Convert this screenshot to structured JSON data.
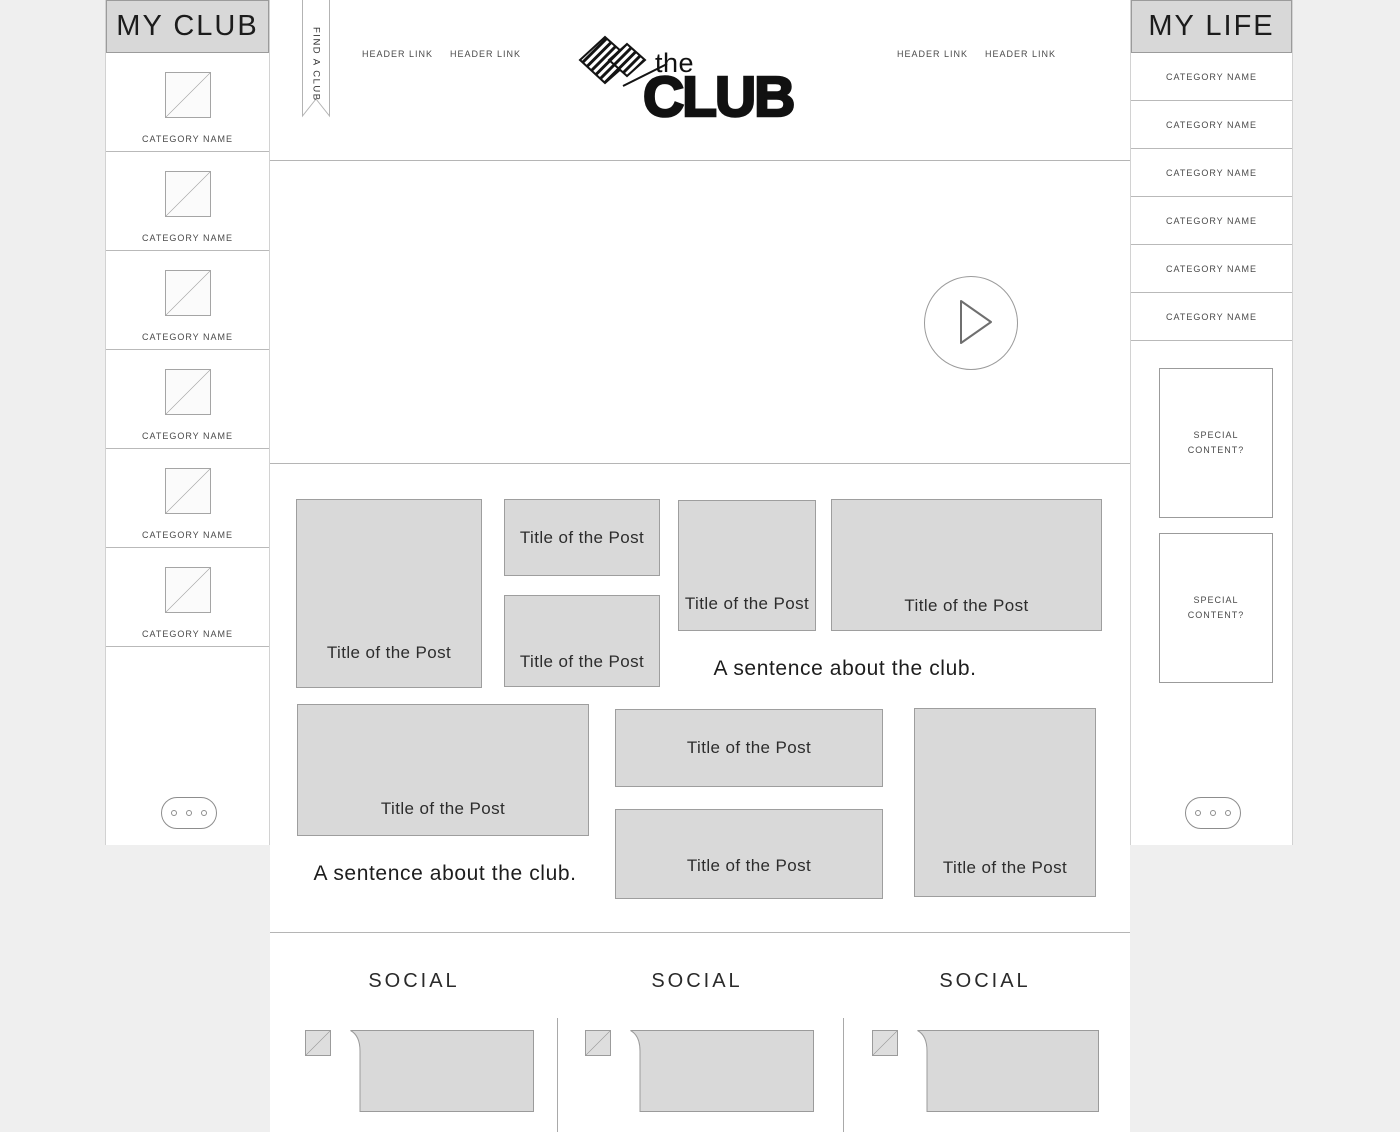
{
  "colors": {
    "page_bg": "#efefef",
    "panel_bg": "#ffffff",
    "box_fill": "#d9d9d9",
    "box_border": "#9b9b9b",
    "text_dark": "#1c1c1c",
    "text_mid": "#4a4a4a"
  },
  "left_sidebar": {
    "title": "MY CLUB",
    "items": [
      {
        "label": "CATEGORY NAME",
        "image": "image-placeholder"
      },
      {
        "label": "CATEGORY NAME",
        "image": "image-placeholder"
      },
      {
        "label": "CATEGORY NAME",
        "image": "image-placeholder"
      },
      {
        "label": "CATEGORY NAME",
        "image": "image-placeholder"
      },
      {
        "label": "CATEGORY NAME",
        "image": "image-placeholder"
      },
      {
        "label": "CATEGORY NAME",
        "image": "image-placeholder"
      }
    ],
    "more_icon": "ellipsis-icon"
  },
  "right_sidebar": {
    "title": "MY LIFE",
    "items": [
      {
        "label": "CATEGORY NAME"
      },
      {
        "label": "CATEGORY NAME"
      },
      {
        "label": "CATEGORY NAME"
      },
      {
        "label": "CATEGORY NAME"
      },
      {
        "label": "CATEGORY NAME"
      },
      {
        "label": "CATEGORY NAME"
      }
    ],
    "special_boxes": [
      {
        "label": "SPECIAL\nCONTENT?"
      },
      {
        "label": "SPECIAL\nCONTENT?"
      }
    ],
    "more_icon": "ellipsis-icon"
  },
  "ribbon": {
    "label": "FIND A CLUB"
  },
  "header": {
    "links": [
      {
        "label": "HEADER LINK"
      },
      {
        "label": "HEADER LINK"
      },
      {
        "label": "HEADER LINK"
      },
      {
        "label": "HEADER LINK"
      }
    ],
    "logo": {
      "the": "the",
      "club": "CLUB",
      "icon": "interlocked-hands-icon"
    }
  },
  "video": {
    "play_icon": "play-icon"
  },
  "posts": {
    "items": [
      {
        "title": "Title of the Post"
      },
      {
        "title": "Title of the Post"
      },
      {
        "title": "Title of the Post"
      },
      {
        "title": "Title of the Post"
      },
      {
        "title": "Title of the Post"
      },
      {
        "title": "Title of the Post"
      },
      {
        "title": "Title of the Post"
      },
      {
        "title": "Title of the Post"
      },
      {
        "title": "Title of the Post"
      }
    ],
    "sentence_right": "A sentence about the club.",
    "sentence_left": "A sentence about the club."
  },
  "social": {
    "columns": [
      {
        "heading": "SOCIAL"
      },
      {
        "heading": "SOCIAL"
      },
      {
        "heading": "SOCIAL"
      }
    ]
  }
}
